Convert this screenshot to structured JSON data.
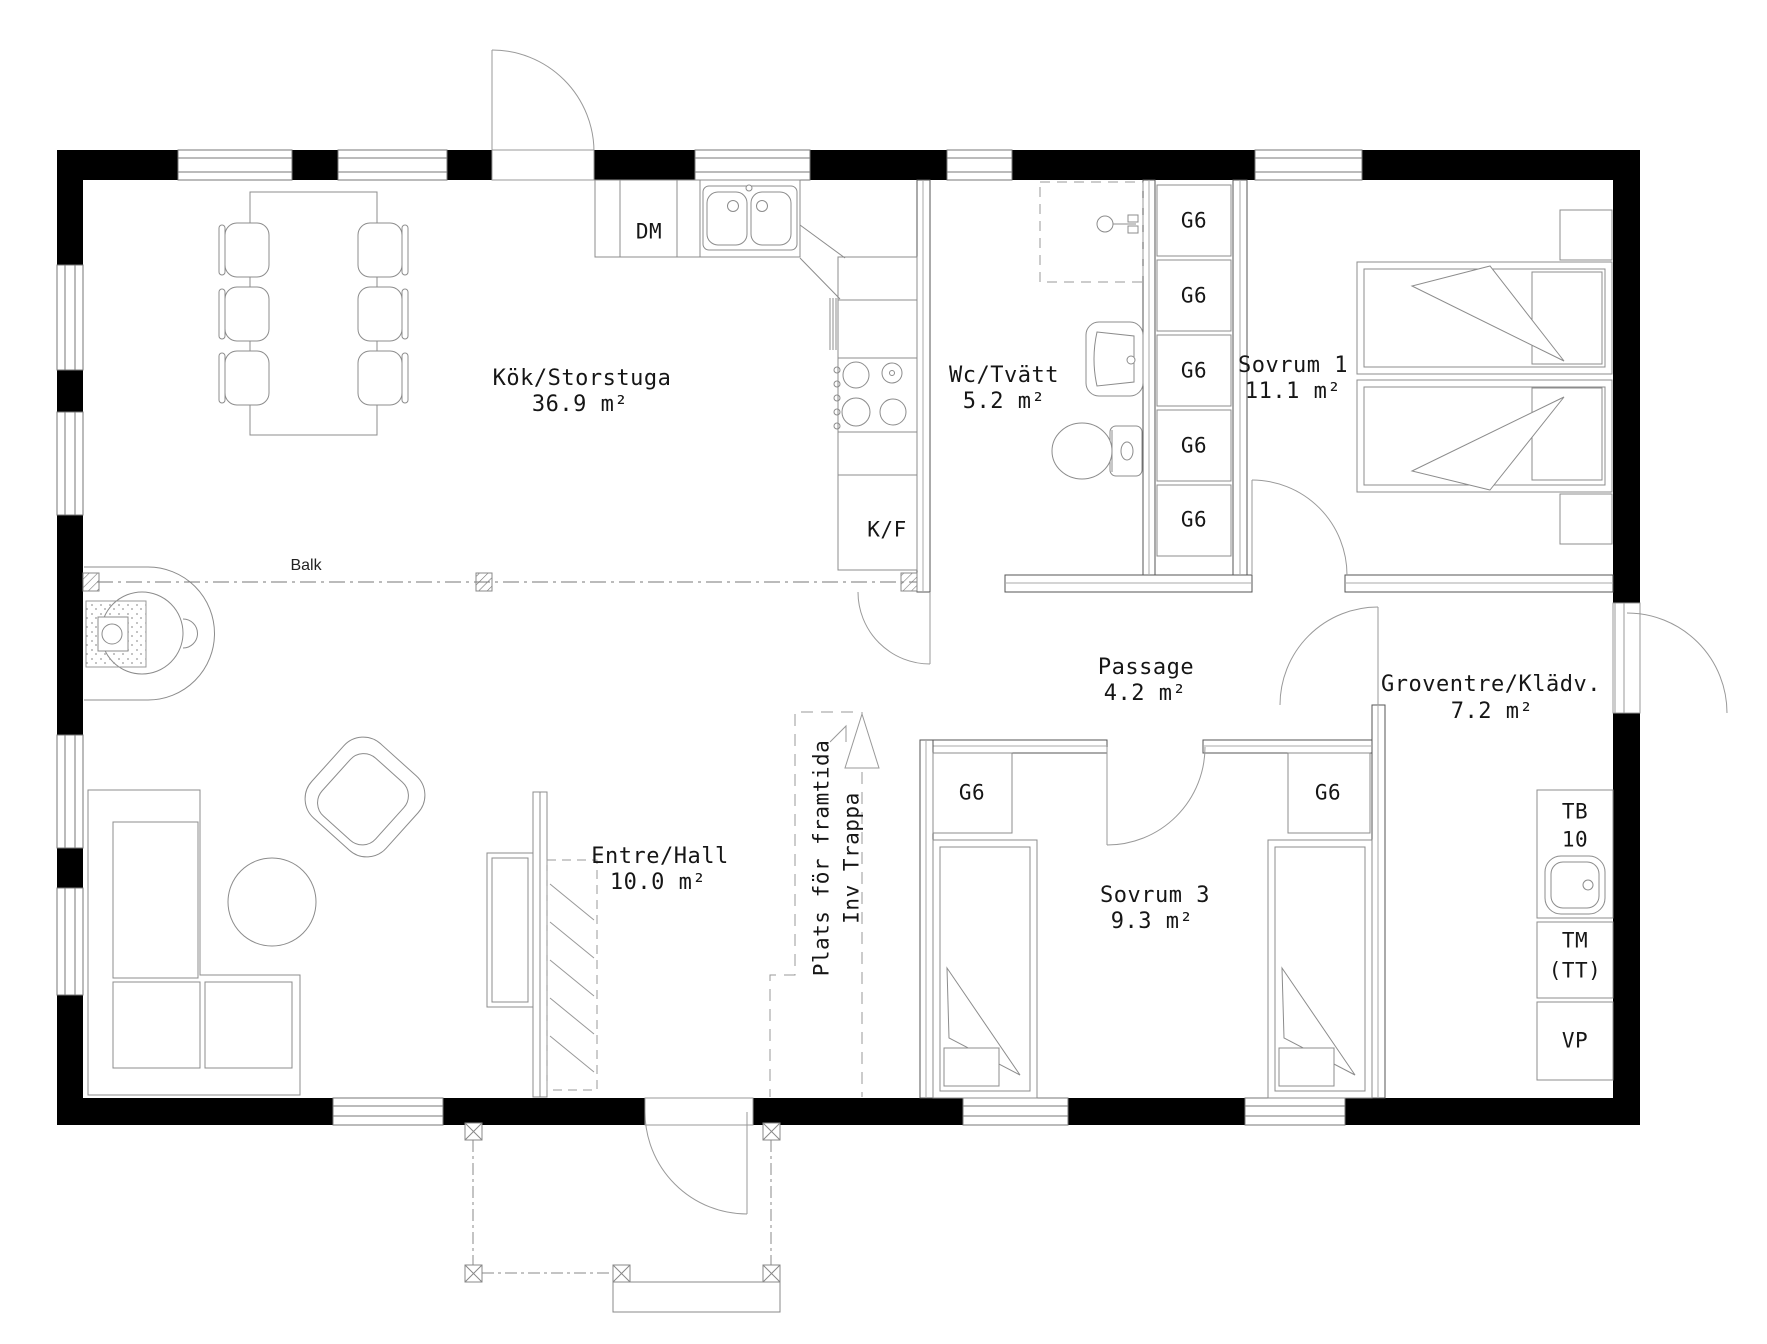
{
  "rooms": [
    {
      "name": "Kök/Storstuga",
      "area": "36.9 m²"
    },
    {
      "name": "Wc/Tvätt",
      "area": "5.2 m²"
    },
    {
      "name": "Sovrum 1",
      "area": "11.1 m²"
    },
    {
      "name": "Passage",
      "area": "4.2 m²"
    },
    {
      "name": "Groventre/Klädv.",
      "area": "7.2 m²"
    },
    {
      "name": "Entre/Hall",
      "area": "10.0 m²"
    },
    {
      "name": "Sovrum 3",
      "area": "9.3 m²"
    }
  ],
  "fixtures": {
    "dishwasher_label": "DM",
    "fridge_freezer_label": "K/F",
    "cabinet_label": "G6",
    "sink_unit_label": "TB",
    "sink_unit_number": "10",
    "washer_label": "TM",
    "washer_note": "(TT)",
    "heater_label": "VP"
  },
  "annotations": {
    "beam_label": "Balk",
    "future_stair_line1": "Plats för framtida",
    "future_stair_line2": "Inv Trappa"
  },
  "colors": {
    "wall": "#000000",
    "thin_line": "#8c8c8c",
    "text": "#161616",
    "background": "#ffffff"
  }
}
